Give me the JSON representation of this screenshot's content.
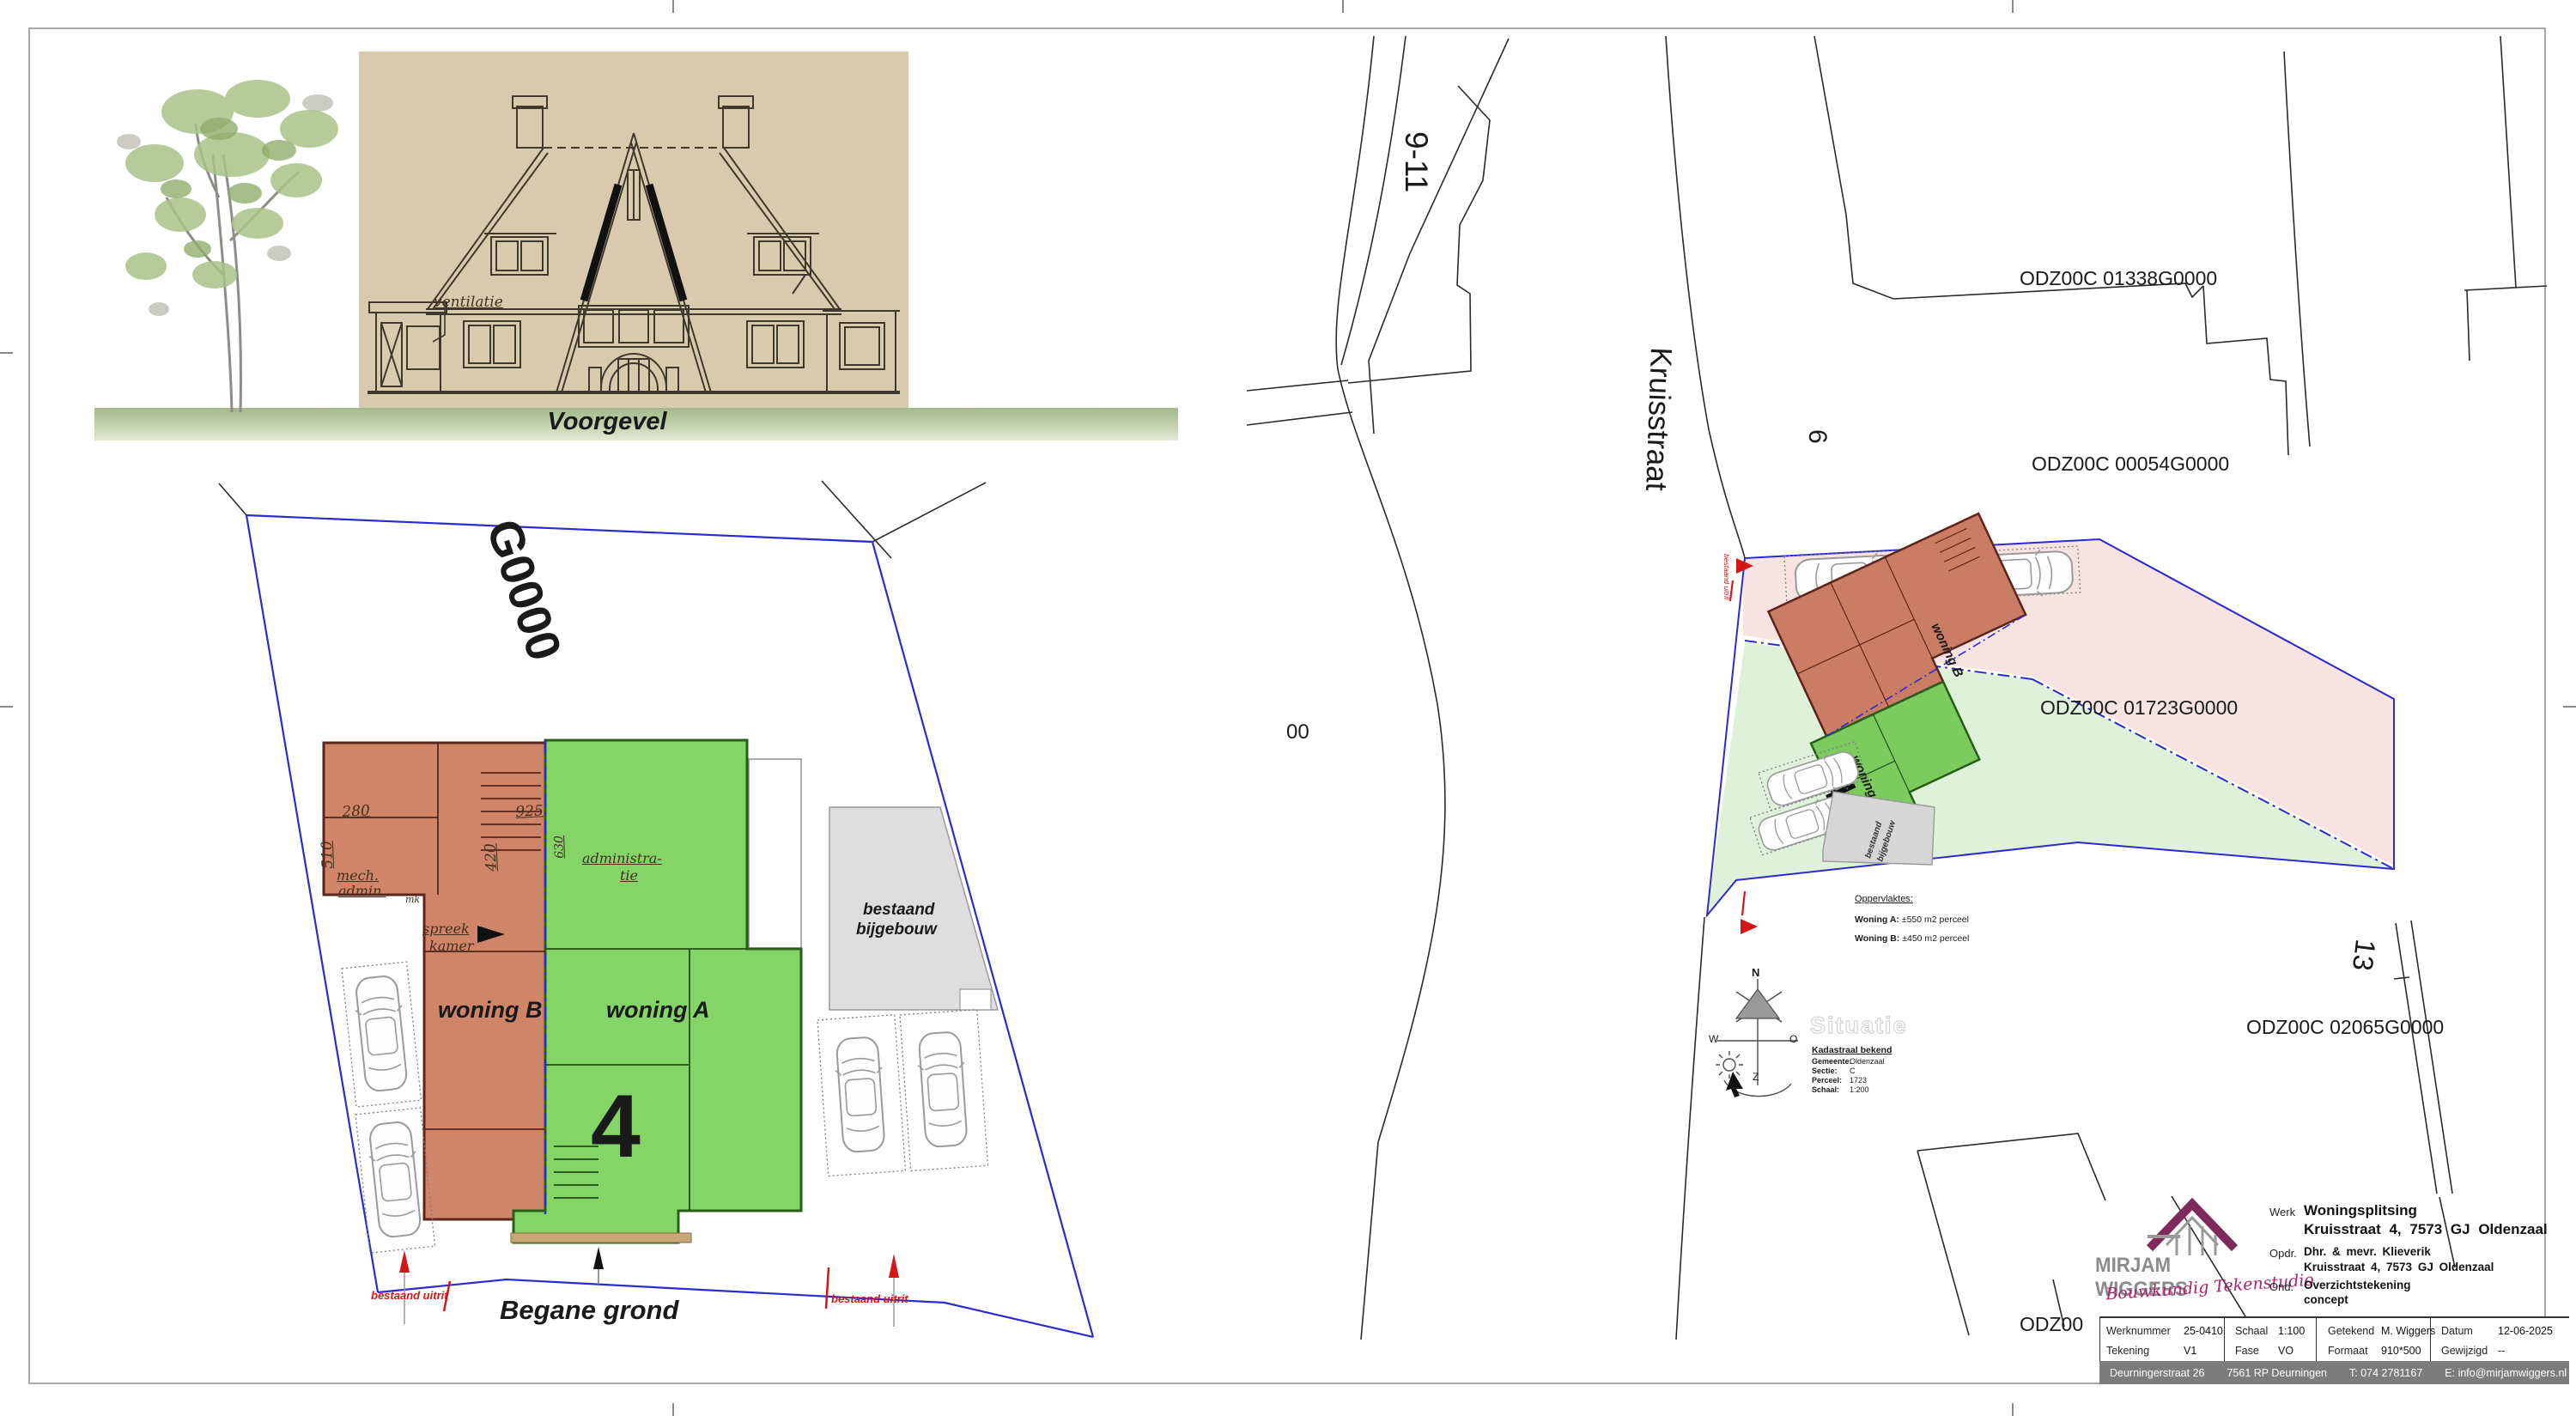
{
  "elevation": {
    "caption": "Voorgevel",
    "annotation": "ventilatie"
  },
  "floor_plan": {
    "title": "Begane grond",
    "big_number": "4",
    "unit_a": "woning A",
    "unit_b": "woning B",
    "parcel_partial": "G0000",
    "rooms": {
      "r1a": "mech.",
      "r1b": "admin.",
      "r2": "mk",
      "r3a": "spreek",
      "r3b": "kamer",
      "r4a": "administra-",
      "r4b": "tie"
    },
    "dims": {
      "d1": "280",
      "d2": "510",
      "d3": "925",
      "d4": "420",
      "d5": "630"
    },
    "outbuilding_line1": "bestaand",
    "outbuilding_line2": "bijgebouw",
    "exit_left": "bestaand uitrit",
    "exit_right": "bestaand uitrit"
  },
  "site_plan": {
    "street": "Kruisstraat",
    "number_left": "9-11",
    "number_mid": "6",
    "number_right": "13",
    "parcels": {
      "p1": "ODZ00C 01338G0000",
      "p2": "ODZ00C 00054G0000",
      "p3": "ODZ00C 01723G0000",
      "p4": "ODZ00C 02065G0000",
      "partial_left": "00",
      "partial_bottom": "ODZ00"
    },
    "unit_a": "woning A",
    "unit_b": "woning B",
    "number_subject": "4",
    "outbuilding_line1": "bestaand",
    "outbuilding_line2": "bijgebouw",
    "exit_label": "bestaand uitrit",
    "areas": {
      "title": "Oppervlaktes:",
      "a_label": "Woning A:",
      "a_value": " ±550 m2 perceel",
      "b_label": "Woning B:",
      "b_value": " ±450 m2 perceel"
    },
    "watermark": "Situatie",
    "cadastral": {
      "title": "Kadastraal bekend",
      "rows": [
        {
          "label": "Gemeente:",
          "value": "Oldenzaal"
        },
        {
          "label": "Sectie:",
          "value": "C"
        },
        {
          "label": "Perceel:",
          "value": "1723"
        },
        {
          "label": "Schaal:",
          "value": "1:200"
        }
      ]
    },
    "compass": {
      "n": "N",
      "w": "W",
      "o": "O",
      "z": "Z"
    }
  },
  "title_block": {
    "logo_name": "MIRJAM WIGGERS",
    "logo_tagline": "Bouwkundig Tekenstudio",
    "rows": {
      "werk_label": "Werk",
      "werk_value1": "Woningsplitsing",
      "werk_value2": "Kruisstraat 4, 7573 GJ Oldenzaal",
      "opdr_label": "Opdr.",
      "opdr_value1": "Dhr. & mevr. Klieverik",
      "opdr_value2": "Kruisstraat 4, 7573 GJ Oldenzaal",
      "ond_label": "Ond.",
      "ond_value1": "Overzichtstekening",
      "ond_value2": "concept"
    },
    "fields": [
      {
        "label": "Werknummer",
        "value": "25-0410"
      },
      {
        "label": "Tekening",
        "value": "V1"
      },
      {
        "label": "Schaal",
        "value": "1:100"
      },
      {
        "label": "Fase",
        "value": "VO"
      },
      {
        "label": "Getekend",
        "value": "M. Wiggers"
      },
      {
        "label": "Formaat",
        "value": "910*500"
      },
      {
        "label": "Datum",
        "value": "12-06-2025"
      },
      {
        "label": "Gewijzigd",
        "value": "--"
      }
    ],
    "footer": {
      "address": "Deurningerstraat 26",
      "city": "7561 RP Deurningen",
      "phone": "T: 074 2781167",
      "email": "E: info@mirjamwiggers.nl",
      "web": "www.mirjamwiggers.nl"
    }
  },
  "colors": {
    "accent_magenta": "#a8246c",
    "logo_gray": "#8c8c8c",
    "parcel_blue": "#2b2bd0",
    "marker_red": "#d51616",
    "plan_red": "#d08468",
    "plan_green": "#84d468",
    "site_pink": "#f8e3e3",
    "site_green": "#def1d9"
  }
}
